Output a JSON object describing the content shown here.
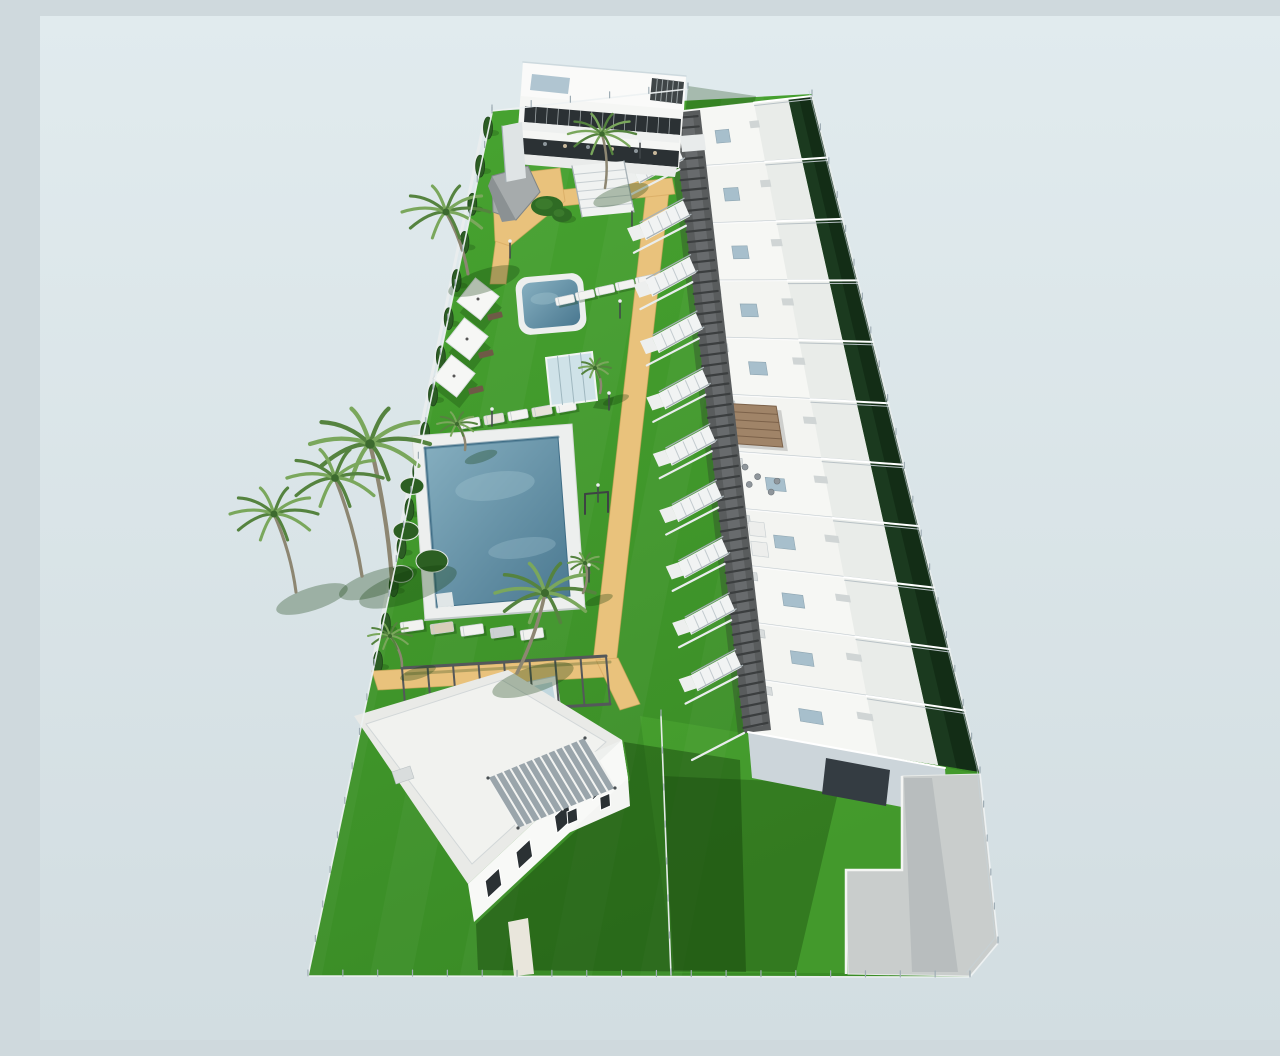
{
  "meta": {
    "description": "Aerial 3D architectural render of a residential development: a stepped row of white townhouses with roof terraces along a dark pergola walkway, communal gardens with two swimming pools, sun loungers, palm trees, a cypress hedge boundary, a detached two-storey villa and an apartment building, all inside a fenced plot on a plain pale blue-grey background.",
    "render_type": "3d-site-plan",
    "text_on_screen": "none"
  },
  "palette": {
    "sky_top": "#e1ebee",
    "sky_bottom": "#d2dde1",
    "grass_light": "#48a531",
    "grass_dark": "#3a8c26",
    "grass_shade": "#2e7a1f",
    "hedge": "#1b3a1f",
    "hedge_dark": "#122a14",
    "cypress": "#2c5d24",
    "sand": "#e9c27c",
    "sand_shade": "#d3a55e",
    "water_light": "#86afc0",
    "water_dark": "#4a7890",
    "deck": "#edefee",
    "white": "#f5f6f4",
    "face_light": "#e3e8e9",
    "face_shade": "#c8d1d6",
    "face_dark": "#aab6be",
    "glazing": "#2b3134",
    "walkway": "#595c5d",
    "walkway_dark": "#3b3e3f",
    "walkway_light": "#7b7f80",
    "wood": "#a08468",
    "wood_dark": "#7c624a",
    "panel_blue": "#a7bfcc",
    "trunk": "#8d8672",
    "frond": "#55833f",
    "frond_light": "#7aa75c",
    "frond_dark": "#3c6a2e",
    "fence": "#eef2f3",
    "fence_post": "#9fadb5",
    "pad": "#c9cdcc",
    "pad_shade": "#a9b0b2",
    "shadow": "#123c0a"
  },
  "scene": {
    "canvas": {
      "w": 1280,
      "h": 1024
    },
    "site_perimeter": [
      [
        452,
        95
      ],
      [
        772,
        78
      ],
      [
        940,
        757
      ],
      [
        958,
        927
      ],
      [
        930,
        961
      ],
      [
        268,
        960
      ]
    ],
    "overlays": {
      "sun_lawn": [
        [
          600,
          700
        ],
        [
          868,
          744
        ],
        [
          938,
          758
        ],
        [
          954,
          924
        ],
        [
          928,
          957
        ],
        [
          634,
          957
        ]
      ],
      "stripes_opacity": 0.035
    },
    "shadows": {
      "villa": [
        [
          584,
          726
        ],
        [
          700,
          744
        ],
        [
          706,
          956
        ],
        [
          438,
          954
        ],
        [
          436,
          908
        ],
        [
          590,
          764
        ]
      ],
      "row_on_lawn": [
        [
          622,
          760
        ],
        [
          800,
          768
        ],
        [
          756,
          956
        ],
        [
          634,
          954
        ]
      ],
      "top_building": [
        [
          648,
          70
        ],
        [
          716,
          80
        ],
        [
          698,
          168
        ],
        [
          640,
          158
        ]
      ],
      "walkway": [
        [
          627,
          99
        ],
        [
          633,
          97
        ],
        [
          704,
          717
        ],
        [
          698,
          719
        ]
      ],
      "pad_band": [
        [
          864,
          762
        ],
        [
          892,
          762
        ],
        [
          918,
          956
        ],
        [
          872,
          956
        ]
      ]
    },
    "townhouse_row": {
      "spine_top": [
        640,
        95
      ],
      "spine_bottom": [
        708,
        718
      ],
      "right_top": [
        772,
        80
      ],
      "right_bottom": [
        940,
        756
      ],
      "unit_count": 11,
      "stair_count": 10,
      "walkway_poly": [
        [
          633,
          97
        ],
        [
          660,
          94
        ],
        [
          731,
          714
        ],
        [
          704,
          717
        ]
      ],
      "walkway_inner": [
        [
          641,
          100
        ],
        [
          653,
          99
        ],
        [
          723,
          710
        ],
        [
          711,
          711
        ]
      ],
      "walk_left_edge": [
        [
          633,
          97
        ],
        [
          704,
          717
        ]
      ],
      "walk_right_edge": [
        [
          657,
          95
        ],
        [
          728,
          712
        ]
      ],
      "north_face": [
        [
          640,
          95
        ],
        [
          772,
          80
        ],
        [
          770,
          96
        ],
        [
          642,
          111
        ]
      ],
      "end_face": [
        [
          708,
          716
        ],
        [
          905,
          752
        ],
        [
          908,
          800
        ],
        [
          712,
          762
        ]
      ],
      "end_recess": [
        [
          786,
          742
        ],
        [
          850,
          754
        ],
        [
          846,
          790
        ],
        [
          782,
          778
        ]
      ],
      "gazebo_unit": 5,
      "sofa_unit": 6,
      "lounger_unit": 7
    },
    "sand_paths": [
      [
        [
          607,
          168
        ],
        [
          630,
          166
        ],
        [
          576,
          648
        ],
        [
          553,
          646
        ]
      ],
      [
        [
          520,
          174
        ],
        [
          632,
          162
        ],
        [
          635,
          178
        ],
        [
          523,
          190
        ]
      ],
      [
        [
          456,
          222
        ],
        [
          472,
          220
        ],
        [
          466,
          268
        ],
        [
          450,
          268
        ]
      ],
      [
        [
          332,
          655
        ],
        [
          560,
          642
        ],
        [
          566,
          661
        ],
        [
          338,
          674
        ]
      ],
      [
        [
          556,
          644
        ],
        [
          578,
          642
        ],
        [
          600,
          688
        ],
        [
          580,
          694
        ]
      ],
      [
        [
          452,
          160
        ],
        [
          520,
          152
        ],
        [
          525,
          185
        ],
        [
          470,
          230
        ],
        [
          455,
          225
        ]
      ]
    ],
    "pools": {
      "main_deck": [
        [
          372,
          420
        ],
        [
          532,
          408
        ],
        [
          545,
          592
        ],
        [
          385,
          604
        ]
      ],
      "main_water": [
        [
          385,
          432
        ],
        [
          518,
          421
        ],
        [
          530,
          580
        ],
        [
          397,
          591
        ]
      ],
      "steps": [
        [
          396,
          578
        ],
        [
          412,
          576
        ],
        [
          414,
          590
        ],
        [
          398,
          592
        ]
      ],
      "upper": {
        "cx": 511,
        "cy": 288,
        "w": 56,
        "h": 46,
        "rot": -5
      },
      "planters": [
        [
          372,
          470,
          12
        ],
        [
          366,
          515,
          13
        ],
        [
          361,
          558,
          12
        ],
        [
          392,
          545,
          16
        ]
      ]
    },
    "lounger_rows": [
      {
        "x": 525,
        "y": 284,
        "dx": 20,
        "dy": -5,
        "n": 5,
        "w": 19,
        "h": 8,
        "rot": -12,
        "colors": [
          "#f3f3f1"
        ]
      },
      {
        "x": 430,
        "y": 407,
        "dx": 24,
        "dy": -4,
        "n": 5,
        "w": 20,
        "h": 9,
        "rot": -10,
        "colors": [
          "#f3f3f1",
          "#e7e3da"
        ]
      },
      {
        "x": 372,
        "y": 610,
        "dx": 30,
        "dy": 2,
        "n": 5,
        "w": 23,
        "h": 10,
        "rot": -8,
        "colors": [
          "#f2f2f0",
          "#d9cfba",
          "#f2f2f0",
          "#ccd1d3",
          "#f2f2f0"
        ]
      }
    ],
    "parasols": [
      [
        438,
        283
      ],
      [
        427,
        323
      ],
      [
        414,
        360
      ]
    ],
    "dark_loungers": [
      [
        455,
        300
      ],
      [
        446,
        338
      ],
      [
        436,
        374
      ]
    ],
    "glass_cabin": [
      [
        506,
        342
      ],
      [
        552,
        336
      ],
      [
        557,
        384
      ],
      [
        511,
        390
      ]
    ],
    "glass_cabin_shadow": [
      [
        557,
        384
      ],
      [
        574,
        381
      ],
      [
        570,
        394
      ],
      [
        553,
        392
      ]
    ],
    "shower_cabin": [
      [
        478,
        668
      ],
      [
        516,
        660
      ],
      [
        522,
        700
      ],
      [
        484,
        708
      ]
    ],
    "shower_glass": [
      [
        484,
        672
      ],
      [
        512,
        666
      ],
      [
        517,
        696
      ],
      [
        489,
        702
      ]
    ],
    "gray_pavilion": [
      [
        452,
        160
      ],
      [
        488,
        150
      ],
      [
        500,
        176
      ],
      [
        476,
        204
      ],
      [
        453,
        196
      ]
    ],
    "gray_pavilion_facet": [
      [
        452,
        160
      ],
      [
        476,
        204
      ],
      [
        462,
        206
      ],
      [
        448,
        170
      ]
    ],
    "garden_bushes": [
      [
        507,
        190,
        16,
        10
      ],
      [
        522,
        199,
        10,
        7
      ]
    ],
    "mini_pergola": {
      "posts": [
        [
          545,
          478
        ],
        [
          568,
          476
        ]
      ],
      "h": 20
    },
    "bottom_pergola": {
      "beam1": [
        [
          362,
          652
        ],
        [
          566,
          640
        ]
      ],
      "beam2": [
        [
          366,
          700
        ],
        [
          570,
          688
        ]
      ],
      "cross": 8
    },
    "top_building": {
      "body": [
        [
          483,
          46
        ],
        [
          646,
          60
        ],
        [
          639,
          152
        ],
        [
          476,
          138
        ]
      ],
      "roof_band": [
        [
          483,
          46
        ],
        [
          646,
          60
        ],
        [
          644,
          94
        ],
        [
          481,
          80
        ]
      ],
      "skylight": [
        [
          492,
          58
        ],
        [
          530,
          62
        ],
        [
          528,
          78
        ],
        [
          490,
          74
        ]
      ],
      "roof_pergola": [
        [
          612,
          62
        ],
        [
          644,
          66
        ],
        [
          642,
          88
        ],
        [
          610,
          84
        ]
      ],
      "glazing_upper": [
        [
          485,
          90
        ],
        [
          641,
          103
        ],
        [
          640,
          119
        ],
        [
          484,
          106
        ]
      ],
      "slab": [
        [
          482,
          106
        ],
        [
          640,
          119
        ],
        [
          639,
          127
        ],
        [
          481,
          114
        ]
      ],
      "glazing_lower": [
        [
          483,
          122
        ],
        [
          639,
          135
        ],
        [
          638,
          151
        ],
        [
          482,
          138
        ]
      ],
      "base_slab": [
        [
          479,
          138
        ],
        [
          637,
          151
        ],
        [
          635,
          161
        ],
        [
          477,
          148
        ]
      ],
      "side_stair": [
        [
          462,
          110
        ],
        [
          482,
          106
        ],
        [
          486,
          162
        ],
        [
          466,
          166
        ]
      ],
      "front_stair": [
        [
          532,
          150
        ],
        [
          584,
          145
        ],
        [
          594,
          196
        ],
        [
          542,
          201
        ]
      ],
      "bridge": [
        [
          640,
          120
        ],
        [
          664,
          118
        ],
        [
          666,
          134
        ],
        [
          642,
          136
        ]
      ]
    },
    "villa": {
      "roof": [
        [
          314,
          700
        ],
        [
          468,
          654
        ],
        [
          582,
          724
        ],
        [
          428,
          868
        ]
      ],
      "roof_inner": [
        [
          326,
          708
        ],
        [
          462,
          664
        ],
        [
          566,
          726
        ],
        [
          432,
          848
        ]
      ],
      "upper_box": [
        [
          500,
          760
        ],
        [
          582,
          724
        ],
        [
          588,
          762
        ],
        [
          506,
          798
        ]
      ],
      "upper_face": [
        [
          506,
          798
        ],
        [
          588,
          762
        ],
        [
          590,
          790
        ],
        [
          508,
          826
        ]
      ],
      "facade": [
        [
          428,
          868
        ],
        [
          582,
          724
        ],
        [
          588,
          762
        ],
        [
          434,
          906
        ]
      ],
      "pergola": [
        [
          448,
          762
        ],
        [
          545,
          722
        ],
        [
          575,
          772
        ],
        [
          478,
          812
        ]
      ],
      "ac_box": [
        [
          352,
          756
        ],
        [
          370,
          750
        ],
        [
          374,
          762
        ],
        [
          356,
          768
        ]
      ],
      "entry_path": [
        [
          468,
          906
        ],
        [
          488,
          902
        ],
        [
          494,
          958
        ],
        [
          474,
          960
        ]
      ],
      "windows_facade_t": [
        0.1,
        0.3,
        0.55,
        0.78
      ],
      "windows_upper_t": [
        0.25,
        0.65
      ]
    },
    "paved_pad": [
      [
        862,
        760
      ],
      [
        940,
        758
      ],
      [
        958,
        928
      ],
      [
        930,
        960
      ],
      [
        808,
        958
      ],
      [
        806,
        854
      ],
      [
        862,
        854
      ]
    ],
    "pad_walls": [
      [
        806,
        958
      ],
      [
        806,
        854
      ],
      [
        862,
        854
      ],
      [
        862,
        760
      ]
    ],
    "palms": [
      {
        "b": [
          565,
          172
        ],
        "t": [
          562,
          118
        ],
        "r": 34
      },
      {
        "b": [
          428,
          258
        ],
        "t": [
          406,
          196
        ],
        "r": 44
      },
      {
        "b": [
          352,
          564
        ],
        "t": [
          330,
          428
        ],
        "r": 60
      },
      {
        "b": [
          322,
          560
        ],
        "t": [
          295,
          462
        ],
        "r": 48
      },
      {
        "b": [
          256,
          576
        ],
        "t": [
          234,
          498
        ],
        "r": 44
      },
      {
        "b": [
          477,
          657
        ],
        "t": [
          505,
          577
        ],
        "r": 50
      },
      {
        "b": [
          425,
          434
        ],
        "t": [
          417,
          408
        ],
        "r": 20
      },
      {
        "b": [
          560,
          377
        ],
        "t": [
          555,
          352
        ],
        "r": 16
      },
      {
        "b": [
          362,
          650
        ],
        "t": [
          350,
          620
        ],
        "r": 22
      },
      {
        "b": [
          543,
          577
        ],
        "t": [
          545,
          547
        ],
        "r": 17
      }
    ],
    "cypress": {
      "from": [
        448,
        112
      ],
      "to": [
        338,
        646
      ],
      "count": 15
    },
    "fences": [
      [
        [
          772,
          80
        ],
        [
          940,
          757
        ],
        [
          958,
          927
        ],
        [
          930,
          961
        ]
      ],
      [
        [
          930,
          961
        ],
        [
          268,
          960
        ]
      ],
      [
        [
          268,
          960
        ],
        [
          452,
          97
        ]
      ],
      [
        [
          452,
          95
        ],
        [
          648,
          73
        ]
      ],
      [
        [
          621,
          700
        ],
        [
          631,
          959
        ]
      ]
    ],
    "light_poles": [
      [
        592,
        210
      ],
      [
        580,
        302
      ],
      [
        569,
        394
      ],
      [
        558,
        486
      ],
      [
        549,
        566
      ],
      [
        470,
        242
      ],
      [
        452,
        410
      ],
      [
        600,
        142
      ]
    ]
  }
}
